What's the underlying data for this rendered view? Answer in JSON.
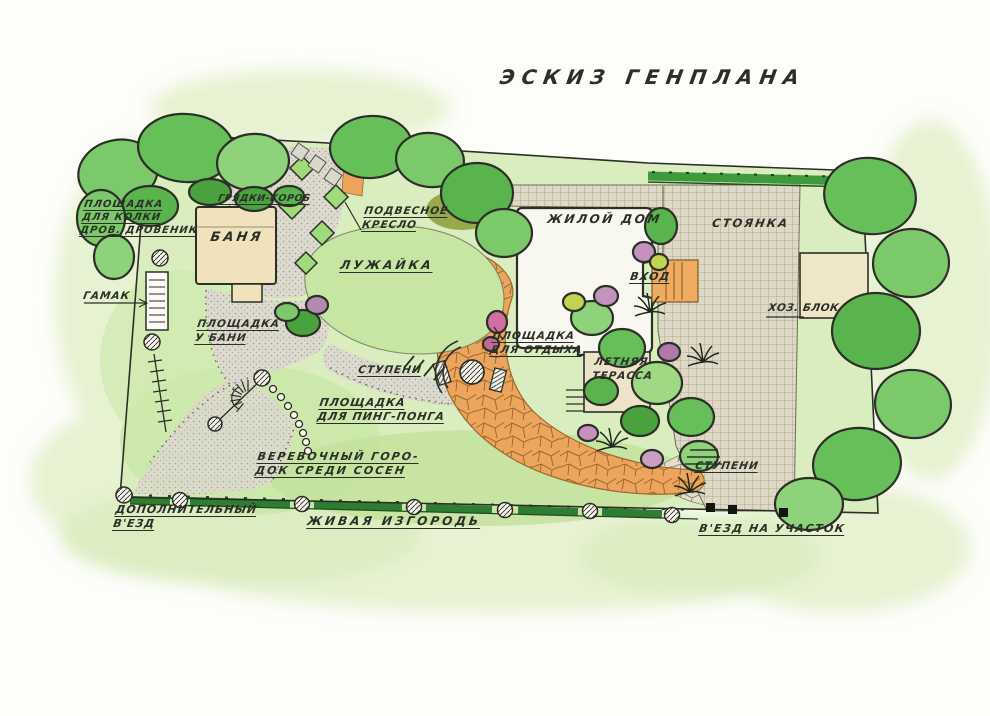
{
  "title": "ЭСКИЗ  ГЕНПЛАНА",
  "plan": {
    "labels": {
      "woodshed": "ПЛОЩАДКА\nДЛЯ КОЛКИ\nДРОВ. ДРОВЕНИК",
      "banya": "БАНЯ",
      "garden_beds": "ГРЯДКИ-КОРОБ",
      "hanging_chair": "ПОДВЕСНОЕ\nКРЕСЛО",
      "lawn": "ЛУЖАЙКА",
      "house": "ЖИЛОЙ ДОМ",
      "parking": "СТОЯНКА",
      "entrance": "ВХОД",
      "utility_block": "ХОЗ. БЛОК",
      "hammock": "ГАМАК",
      "banya_ground": "ПЛОЩАДКА\nУ БАНИ",
      "steps_center": "СТУПЕНИ",
      "rest_area": "ПЛОЩАДКА\nДЛЯ ОТДЫХА",
      "summer_terrace": "ЛЕТНЯЯ\nТЕРАССА",
      "ping_pong": "ПЛОЩАДКА\nДЛЯ ПИНГ-ПОНГА",
      "rope_park": "ВЕРЕВОЧНЫЙ ГОРО-\nДОК СРЕДИ СОСЕН",
      "steps_right": "СТУПЕНИ",
      "extra_entrance": "ДОПОЛНИТЕЛЬНЫЙ\nВ'ЕЗД",
      "hedge": "ЖИВАЯ ИЗГОРОДЬ",
      "main_entrance": "В'ЕЗД НА УЧАСТОК"
    }
  },
  "palette": {
    "paper": "#fdfdfa",
    "ink": "#2b2f28",
    "wash": "#e7f2d2",
    "field": "#d9edbf",
    "lawn": "#c7e6a4",
    "gravel": "#dcd9ce",
    "gravelDot": "#8e8872",
    "paving": "#ded9c6",
    "pavingLine": "#a29a80",
    "flagstone": "#eda55d",
    "flagstoneLine": "#9c6a2e",
    "pathStone": "#e4decb",
    "building": "#efe2bd",
    "house": "#f8f7f0",
    "hedge": "#2e7d32",
    "hedgeTop": "#3f9a3f",
    "tree1": "#66bf58",
    "tree2": "#7bc96a",
    "tree3": "#8ed27c",
    "tree4": "#5ab44e",
    "treeDark": "#4aa23e",
    "olive": "#98a84c",
    "purple": "#c393bd",
    "pink": "#d06fa0",
    "yellow": "#c4d251",
    "post": "#15150f"
  }
}
